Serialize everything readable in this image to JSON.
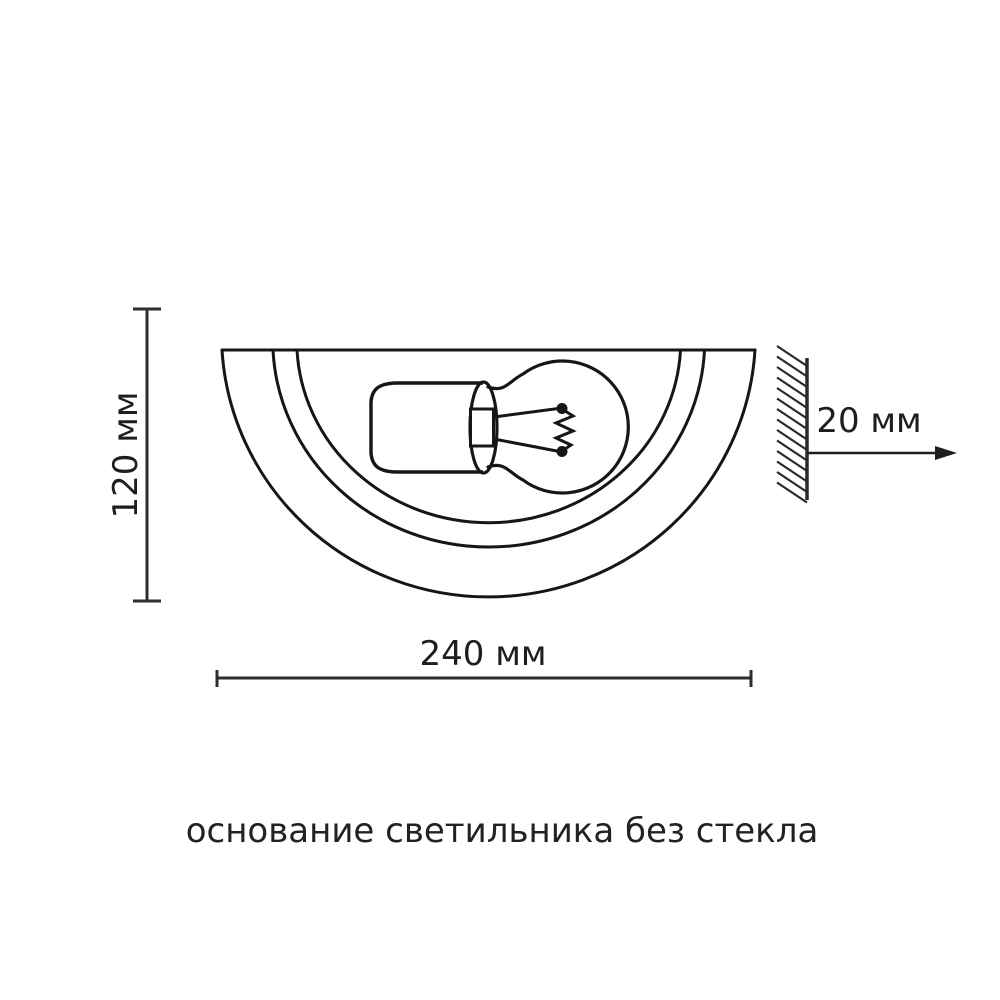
{
  "diagram": {
    "type": "technical dimension drawing of a half-round wall lamp base with bulb",
    "dimensions": {
      "height_label": "120 мм",
      "width_label": "240 мм",
      "wall_offset_label": "20 мм"
    },
    "caption": "основание светильника без стекла",
    "colors": {
      "background": "#ffffff",
      "outline": "#161616",
      "dimension_line": "#2e2e2e",
      "text": "#1e1e1e"
    },
    "shapes": [
      "lamp-base-semicircles",
      "lamp-socket",
      "light-bulb",
      "filament",
      "wall-with-hatching",
      "offset-arrow",
      "height-dimension",
      "width-dimension"
    ]
  }
}
